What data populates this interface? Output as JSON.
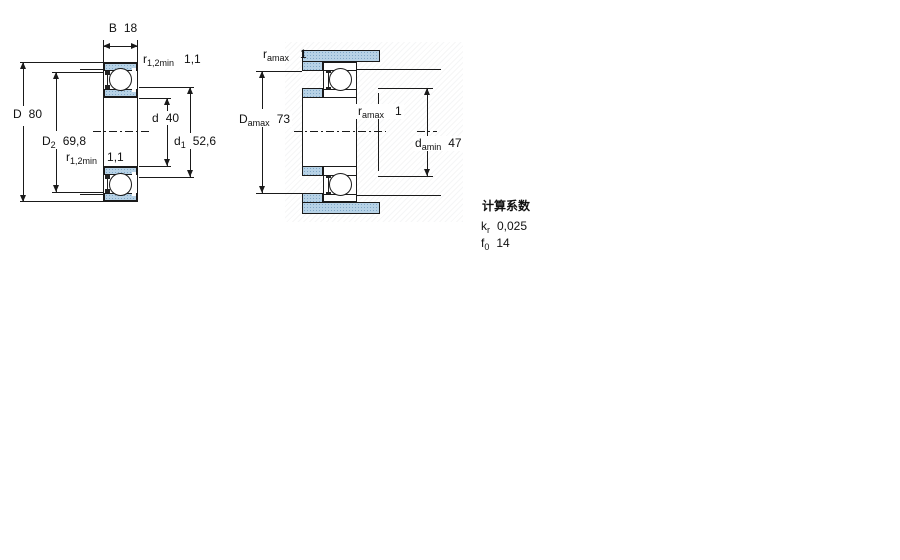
{
  "drawing": {
    "type": "bearing-cross-section",
    "left_view": {
      "b": {
        "label": "B",
        "value": "18"
      },
      "r_top": {
        "sym": "r",
        "sub": "1,2min",
        "value": "1,1"
      },
      "r_bottom": {
        "sym": "r",
        "sub": "1,2min",
        "value": "1,1"
      },
      "D": {
        "sym": "D",
        "value": "80"
      },
      "D2": {
        "sym": "D",
        "sub": "2",
        "value": "69,8"
      },
      "d": {
        "sym": "d",
        "value": "40"
      },
      "d1": {
        "sym": "d",
        "sub": "1",
        "value": "52,6"
      }
    },
    "right_view": {
      "ra_top": {
        "sym": "r",
        "sub": "amax",
        "value": "1"
      },
      "Damax": {
        "sym": "D",
        "sub": "amax",
        "value": "73"
      },
      "ra_mid": {
        "sym": "r",
        "sub": "amax",
        "value": "1"
      },
      "damin": {
        "sym": "d",
        "sub": "amin",
        "value": "47"
      }
    },
    "factors": {
      "title": "计算系数",
      "kr": {
        "sym": "k",
        "sub": "r",
        "value": "0,025"
      },
      "f0": {
        "sym": "f",
        "sub": "0",
        "value": "14"
      }
    }
  },
  "colors": {
    "ring_fill": "#b7d2e6",
    "ring_dot": "#7fa7c7",
    "line": "#1a1a1a"
  }
}
